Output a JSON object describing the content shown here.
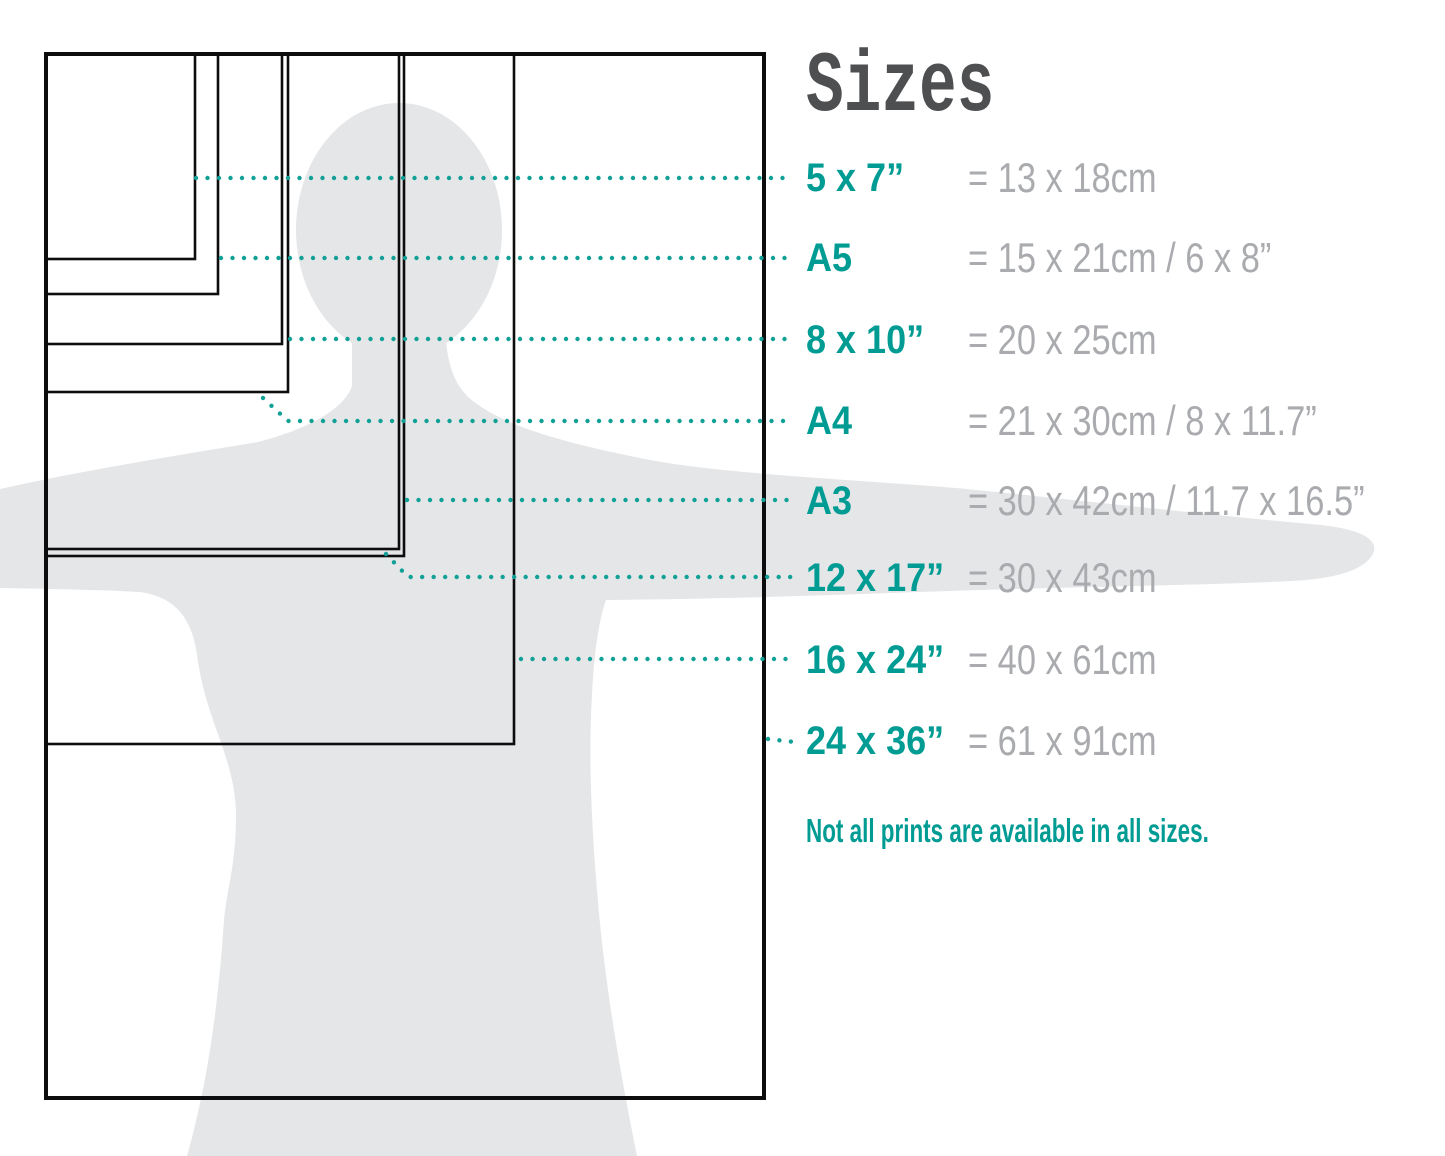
{
  "title": "Sizes",
  "note": "Not all prints are available in all sizes.",
  "colors": {
    "teal": "#009c94",
    "dot": "#10a096",
    "gray_text": "#a9abae",
    "title": "#4e4f51",
    "silhouette": "#e5e6e8",
    "line": "#0d0d0d",
    "background": "#ffffff"
  },
  "diagram": {
    "canvas_w": 1445,
    "canvas_h": 1156,
    "origin_x": 46,
    "origin_y": 54
  },
  "sizes": [
    {
      "id": "5x7",
      "label": "5 x 7”",
      "equiv": "= 13 x 18cm",
      "row_y": 178,
      "rect_w": 149,
      "rect_h": 205,
      "callout": "196,178 792,178"
    },
    {
      "id": "a5",
      "label": "A5",
      "equiv": "= 15 x 21cm / 6 x 8”",
      "row_y": 258,
      "rect_w": 172,
      "rect_h": 240,
      "callout": "221,258 792,258"
    },
    {
      "id": "8x10",
      "label": "8 x 10”",
      "equiv": "= 20 x 25cm",
      "row_y": 340,
      "rect_w": 236,
      "rect_h": 290,
      "callout": "290,339 792,339"
    },
    {
      "id": "a4",
      "label": "A4",
      "equiv": "= 21 x 30cm / 8 x 11.7”",
      "row_y": 421,
      "rect_w": 242,
      "rect_h": 338,
      "callout": "263,398 288,421 792,421"
    },
    {
      "id": "a3",
      "label": "A3",
      "equiv": "= 30 x 42cm / 11.7 x 16.5”",
      "row_y": 501,
      "rect_w": 353,
      "rect_h": 495,
      "callout": "407,500 792,500"
    },
    {
      "id": "12x17",
      "label": "12 x 17”",
      "equiv": "= 30 x 43cm",
      "row_y": 578,
      "rect_w": 358,
      "rect_h": 502,
      "callout": "386,554 408,577 792,577"
    },
    {
      "id": "16x24",
      "label": "16 x 24”",
      "equiv": "= 40 x 61cm",
      "row_y": 660,
      "rect_w": 468,
      "rect_h": 690,
      "callout": "521,659 792,659"
    },
    {
      "id": "24x36",
      "label": "24 x 36”",
      "equiv": "= 61 x 91cm",
      "row_y": 741,
      "rect_w": 718,
      "rect_h": 1044,
      "callout": "768,739 795,742"
    }
  ]
}
